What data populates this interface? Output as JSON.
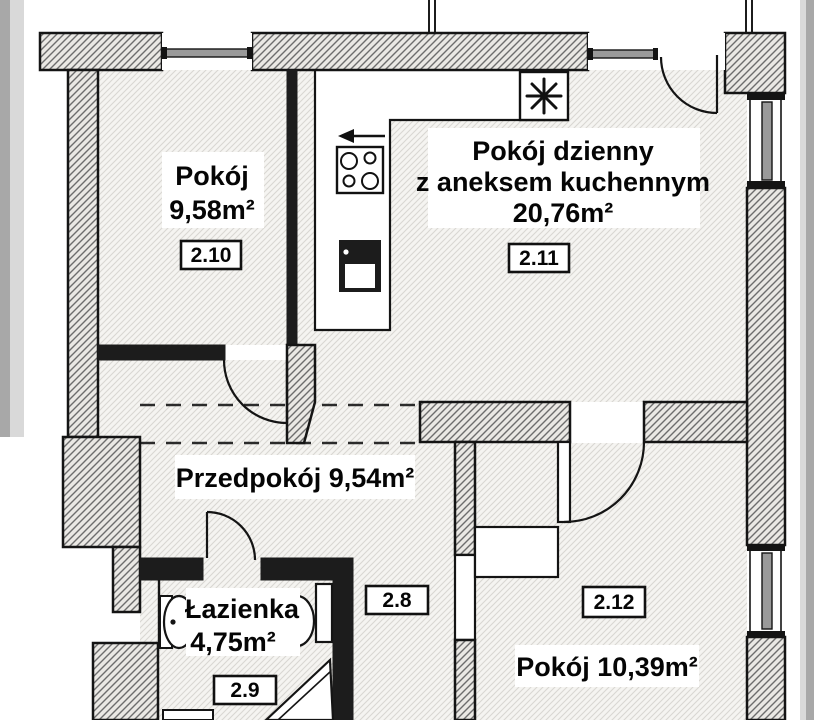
{
  "colors": {
    "outline": "#141414",
    "wall_fill": "#eae8e4",
    "wall_hatch": "#6d6d6d",
    "floor_fill": "#f5f4f1",
    "floor_hatch": "#d9d7d2",
    "side_strip_dark": "#a8a8a8",
    "side_strip_light": "#d9d9d9",
    "label_text": "#050505",
    "badge_bg": "#ffffff"
  },
  "rooms": {
    "r210": {
      "id": "2.10",
      "name": "Pokój",
      "area": "9,58m²"
    },
    "r211": {
      "id": "2.11",
      "name_line1": "Pokój dzienny",
      "name_line2": "z aneksem kuchennym",
      "area": "20,76m²"
    },
    "hall": {
      "label": "Przedpokój 9,54m²"
    },
    "corridor": {
      "id": "2.8"
    },
    "bath": {
      "id": "2.9",
      "name": "Łazienka",
      "area": "4,75m²"
    },
    "r212": {
      "id": "2.12",
      "label": "Pokój 10,39m²"
    }
  },
  "icons": {
    "fridge": "asterisk-snowflake",
    "hood_arrow": "left-arrow",
    "stove": "four-burner-stove",
    "sink": "kitchen-sink",
    "washbasin": "oval-washbasin",
    "toilet": "toilet-with-cistern",
    "shower": "corner-shower"
  }
}
